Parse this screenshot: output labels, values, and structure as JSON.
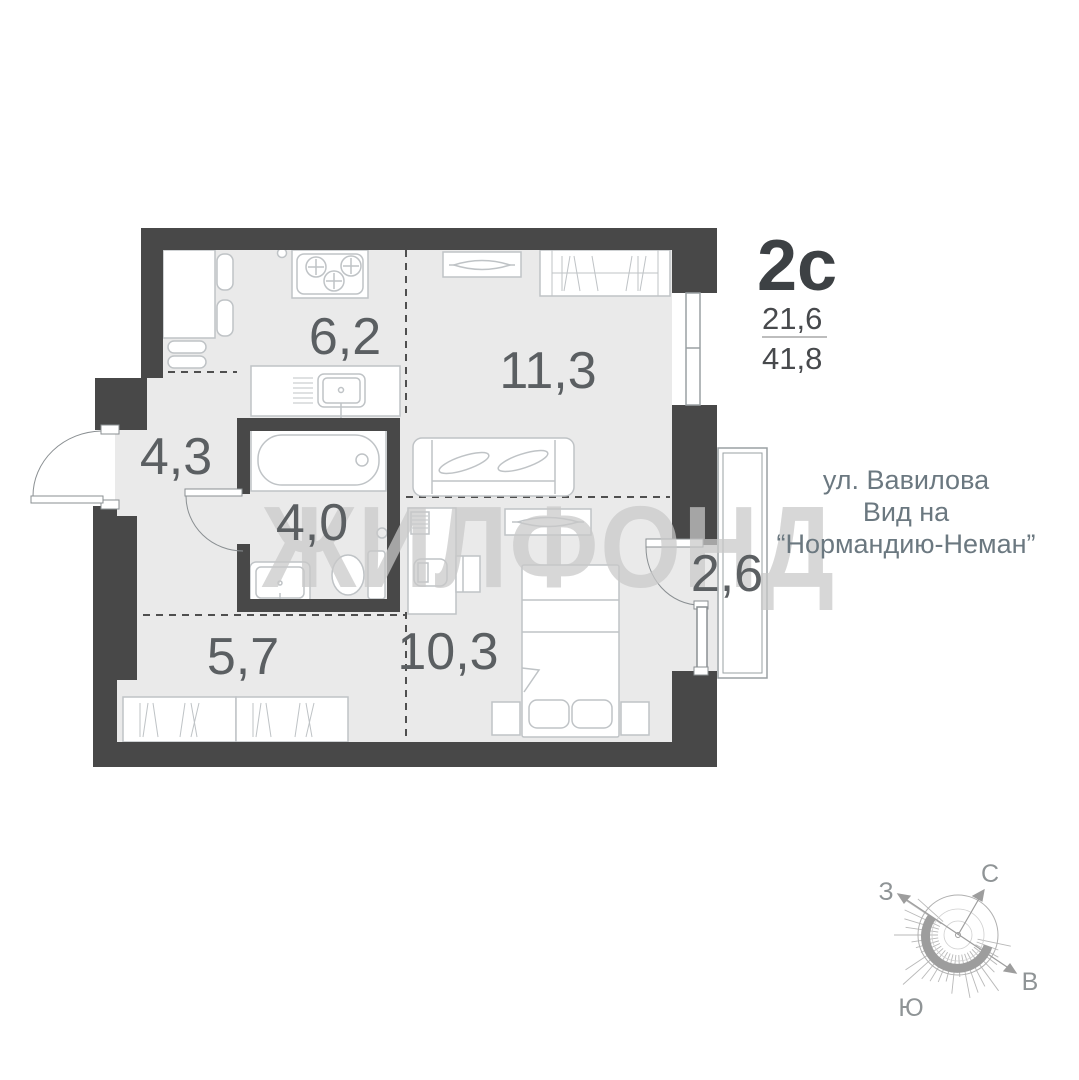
{
  "plan": {
    "title": "2с",
    "area_living": "21,6",
    "area_total": "41,8",
    "address_line1": "ул. Вавилова",
    "address_line2": "Вид на",
    "address_line3": "“Нормандию-Неман”",
    "watermark": "ЖИЛФОНД",
    "rooms": [
      {
        "name": "kitchen",
        "area": "6,2"
      },
      {
        "name": "living-room",
        "area": "11,3"
      },
      {
        "name": "hallway",
        "area": "4,3"
      },
      {
        "name": "bathroom",
        "area": "4,0"
      },
      {
        "name": "balcony",
        "area": "2,6"
      },
      {
        "name": "wardrobe",
        "area": "5,7"
      },
      {
        "name": "bedroom",
        "area": "10,3"
      }
    ],
    "compass": {
      "north": "С",
      "south": "Ю",
      "east": "В",
      "west": "З"
    },
    "colors": {
      "wall": "#484848",
      "floor": "#eaeaea",
      "furniture_stroke": "#bfc3c6",
      "label_text": "#5b5f62",
      "address_text": "#6b7880",
      "watermark": "#c9c9c9"
    }
  }
}
